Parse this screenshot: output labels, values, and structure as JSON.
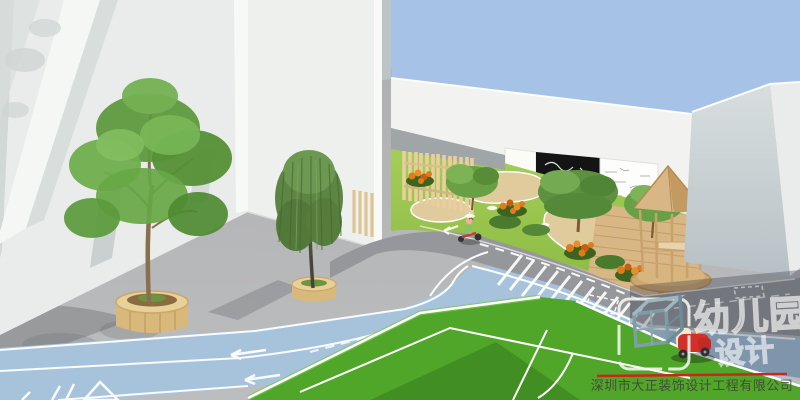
{
  "scene": {
    "description": "3D architectural rendering of a kindergarten outdoor area: white buildings, street trees in round wooden planters, blue cycle lane with left arrows, curved garden paths, picket fence, chalkboard wall, wooden gazebo and a green sports field",
    "sky_color": "#a6c3e7"
  },
  "watermark": {
    "brand_line1": "幼儿园",
    "brand_line2": "设计",
    "company_name": "深圳市大正装饰设计工程有限公司",
    "logo": "isometric-cube"
  },
  "palette": {
    "sky": "#a6c3e7",
    "building_white": "#edf0ee",
    "wall_white": "#f2f3f0",
    "sidewalk_gray": "#b4b5b7",
    "road_gray": "#96979a",
    "track_blue": "#a6c3db",
    "playground_grass": "#98c24d",
    "sports_field_green": "#50a628",
    "sand_path": "#e0cb9c",
    "wood": "#d8b685",
    "flower_orange": "#e07a1e",
    "toy_car_red": "#d2302a",
    "divider_red": "#cf241b"
  },
  "markings": {
    "lane_arrow_direction": "left",
    "crosswalk_style": "diagonal-hatch",
    "field_lines": "white pitch lines"
  }
}
